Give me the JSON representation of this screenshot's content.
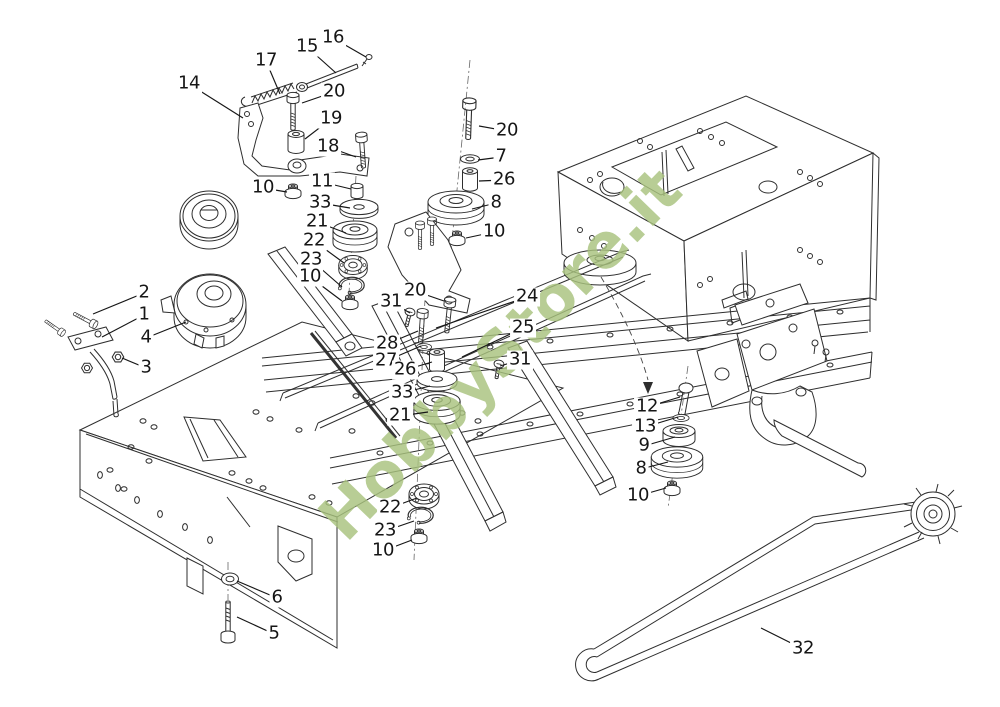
{
  "watermark": {
    "text": "HobbyStore.it",
    "color": "#a9c37e"
  },
  "diagram": {
    "type": "exploded-parts-diagram",
    "visible_part_numbers": [
      "1",
      "2",
      "3",
      "4",
      "5",
      "6",
      "7",
      "8",
      "9",
      "10",
      "11",
      "12",
      "13",
      "14",
      "15",
      "16",
      "17",
      "18",
      "19",
      "20",
      "21",
      "22",
      "23",
      "24",
      "25",
      "26",
      "27",
      "28",
      "31",
      "32",
      "33"
    ],
    "callouts": [
      {
        "label": "16",
        "x": 333,
        "y": 38,
        "tx": 366,
        "ty": 57
      },
      {
        "label": "15",
        "x": 307,
        "y": 47,
        "tx": 336,
        "ty": 73
      },
      {
        "label": "17",
        "x": 266,
        "y": 61,
        "tx": 280,
        "ty": 94
      },
      {
        "label": "14",
        "x": 189,
        "y": 84,
        "tx": 243,
        "ty": 118
      },
      {
        "label": "20",
        "x": 334,
        "y": 92,
        "tx": 302,
        "ty": 103
      },
      {
        "label": "19",
        "x": 331,
        "y": 119,
        "tx": 305,
        "ty": 139
      },
      {
        "label": "18",
        "x": 328,
        "y": 147,
        "tx": 356,
        "ty": 157
      },
      {
        "label": "10",
        "x": 263,
        "y": 188,
        "tx": 287,
        "ty": 192
      },
      {
        "label": "11",
        "x": 322,
        "y": 182,
        "tx": 351,
        "ty": 189
      },
      {
        "label": "33",
        "x": 320,
        "y": 203,
        "tx": 350,
        "ty": 208
      },
      {
        "label": "21",
        "x": 317,
        "y": 222,
        "tx": 346,
        "ty": 233
      },
      {
        "label": "22",
        "x": 314,
        "y": 241,
        "tx": 344,
        "ty": 263
      },
      {
        "label": "23",
        "x": 311,
        "y": 260,
        "tx": 342,
        "ty": 287
      },
      {
        "label": "10",
        "x": 310,
        "y": 277,
        "tx": 342,
        "ty": 301
      },
      {
        "label": "20",
        "x": 507,
        "y": 131,
        "tx": 479,
        "ty": 126
      },
      {
        "label": "7",
        "x": 501,
        "y": 157,
        "tx": 478,
        "ty": 160
      },
      {
        "label": "26",
        "x": 504,
        "y": 180,
        "tx": 479,
        "ty": 181
      },
      {
        "label": "8",
        "x": 496,
        "y": 203,
        "tx": 472,
        "ty": 209
      },
      {
        "label": "10",
        "x": 494,
        "y": 232,
        "tx": 466,
        "ty": 238
      },
      {
        "label": "2",
        "x": 144,
        "y": 293,
        "tx": 93,
        "ty": 314
      },
      {
        "label": "1",
        "x": 144,
        "y": 315,
        "tx": 102,
        "ty": 337
      },
      {
        "label": "4",
        "x": 146,
        "y": 338,
        "tx": 186,
        "ty": 322
      },
      {
        "label": "3",
        "x": 146,
        "y": 368,
        "tx": 122,
        "ty": 358
      },
      {
        "label": "20",
        "x": 415,
        "y": 291,
        "tx": 444,
        "ty": 301
      },
      {
        "label": "31",
        "x": 391,
        "y": 302,
        "tx": 410,
        "ty": 313
      },
      {
        "label": "28",
        "x": 387,
        "y": 344,
        "tx": 418,
        "ty": 331
      },
      {
        "label": "27",
        "x": 386,
        "y": 361,
        "tx": 421,
        "ty": 346
      },
      {
        "label": "26",
        "x": 405,
        "y": 370,
        "tx": 432,
        "ty": 362
      },
      {
        "label": "33",
        "x": 402,
        "y": 393,
        "tx": 430,
        "ty": 386
      },
      {
        "label": "21",
        "x": 400,
        "y": 416,
        "tx": 428,
        "ty": 412
      },
      {
        "label": "24",
        "x": 527,
        "y": 297,
        "tx": 436,
        "ty": 328
      },
      {
        "label": "25",
        "x": 523,
        "y": 328,
        "tx": 462,
        "ty": 357
      },
      {
        "label": "31",
        "x": 520,
        "y": 360,
        "tx": 500,
        "ty": 366
      },
      {
        "label": "12",
        "x": 647,
        "y": 407,
        "tx": 680,
        "ty": 397
      },
      {
        "label": "13",
        "x": 645,
        "y": 427,
        "tx": 678,
        "ty": 417
      },
      {
        "label": "9",
        "x": 644,
        "y": 446,
        "tx": 675,
        "ty": 437
      },
      {
        "label": "8",
        "x": 641,
        "y": 469,
        "tx": 668,
        "ty": 462
      },
      {
        "label": "10",
        "x": 638,
        "y": 496,
        "tx": 666,
        "ty": 488
      },
      {
        "label": "22",
        "x": 390,
        "y": 508,
        "tx": 417,
        "ty": 498
      },
      {
        "label": "23",
        "x": 385,
        "y": 531,
        "tx": 414,
        "ty": 521
      },
      {
        "label": "10",
        "x": 383,
        "y": 551,
        "tx": 412,
        "ty": 540
      },
      {
        "label": "6",
        "x": 277,
        "y": 598,
        "tx": 237,
        "ty": 581
      },
      {
        "label": "5",
        "x": 274,
        "y": 634,
        "tx": 237,
        "ty": 617
      },
      {
        "label": "32",
        "x": 803,
        "y": 649,
        "tx": 761,
        "ty": 628
      }
    ]
  }
}
